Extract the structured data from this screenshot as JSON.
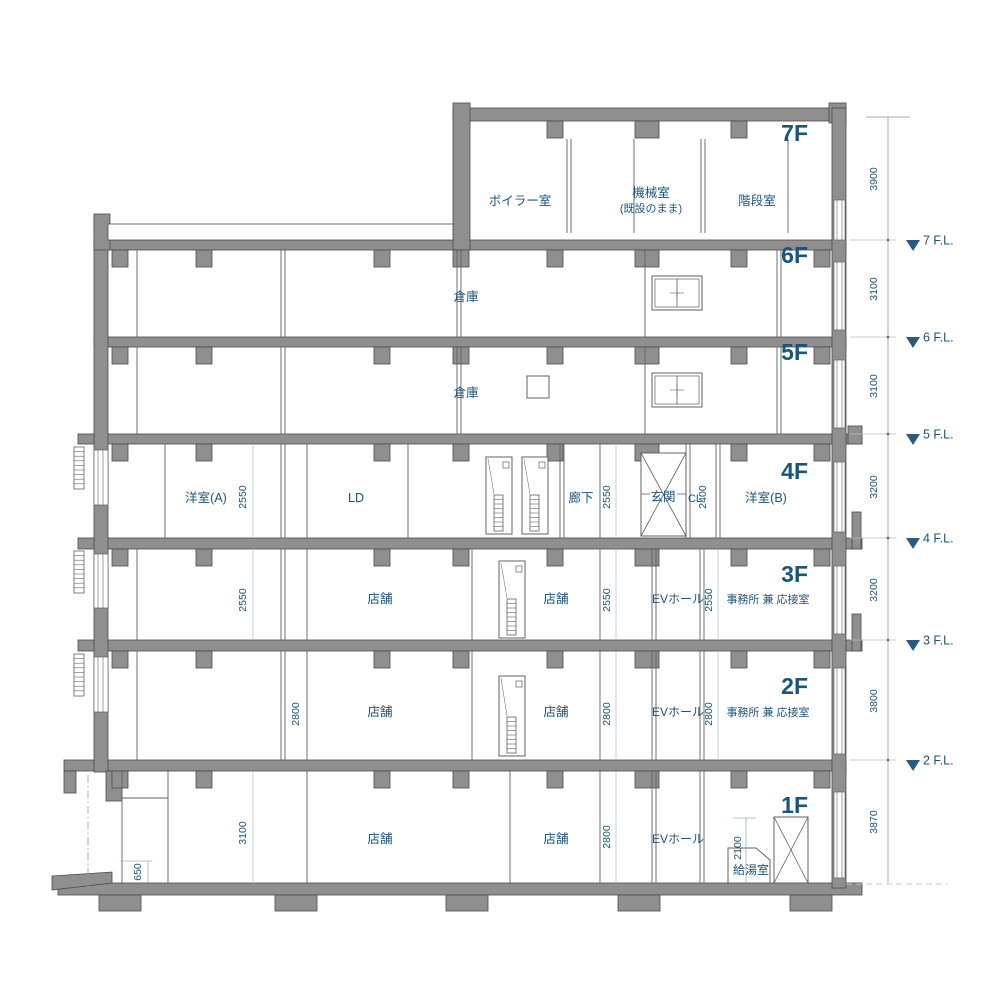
{
  "drawing": {
    "title": "building-cross-section",
    "colors": {
      "concrete_fill": "#8f8f8f",
      "concrete_stroke": "#4a4a4a",
      "thin_line": "#606060",
      "dim_line": "#9db7ca",
      "annotation_blue": "#1d5377",
      "fl_triangle": "#2a5a80"
    },
    "floor_labels": [
      {
        "text": "7F",
        "x": 808,
        "y": 141
      },
      {
        "text": "6F",
        "x": 808,
        "y": 263
      },
      {
        "text": "5F",
        "x": 808,
        "y": 360
      },
      {
        "text": "4F",
        "x": 808,
        "y": 479
      },
      {
        "text": "3F",
        "x": 808,
        "y": 582
      },
      {
        "text": "2F",
        "x": 808,
        "y": 694
      },
      {
        "text": "1F",
        "x": 808,
        "y": 813
      }
    ],
    "room_labels": [
      {
        "text": "ボイラー室",
        "x": 520,
        "y": 205,
        "size": 12.5
      },
      {
        "text": "機械室",
        "x": 651,
        "y": 197,
        "size": 12.5
      },
      {
        "text": "(既設のまま)",
        "x": 651,
        "y": 212,
        "size": 11
      },
      {
        "text": "階段室",
        "x": 757,
        "y": 205,
        "size": 12.5
      },
      {
        "text": "倉庫",
        "x": 466,
        "y": 301,
        "size": 12.5
      },
      {
        "text": "倉庫",
        "x": 466,
        "y": 397,
        "size": 12.5
      },
      {
        "text": "洋室(A)",
        "x": 206,
        "y": 502,
        "size": 12.5
      },
      {
        "text": "LD",
        "x": 356,
        "y": 502,
        "size": 12.5
      },
      {
        "text": "廊下",
        "x": 581,
        "y": 502,
        "size": 12.5
      },
      {
        "text": "玄関",
        "x": 663,
        "y": 501,
        "size": 12.5
      },
      {
        "text": "CL",
        "x": 695,
        "y": 502,
        "size": 11
      },
      {
        "text": "洋室(B)",
        "x": 766,
        "y": 502,
        "size": 12.5
      },
      {
        "text": "店舗",
        "x": 380,
        "y": 603,
        "size": 12.5
      },
      {
        "text": "店舗",
        "x": 556,
        "y": 603,
        "size": 12.5
      },
      {
        "text": "EVホール",
        "x": 678,
        "y": 603,
        "size": 12
      },
      {
        "text": "事務所 兼 応接室",
        "x": 768,
        "y": 603,
        "size": 11
      },
      {
        "text": "店舗",
        "x": 380,
        "y": 716,
        "size": 12.5
      },
      {
        "text": "店舗",
        "x": 556,
        "y": 716,
        "size": 12.5
      },
      {
        "text": "EVホール",
        "x": 678,
        "y": 716,
        "size": 12
      },
      {
        "text": "事務所 兼 応接室",
        "x": 768,
        "y": 716,
        "size": 11
      },
      {
        "text": "店舗",
        "x": 380,
        "y": 843,
        "size": 12.5
      },
      {
        "text": "店舗",
        "x": 556,
        "y": 843,
        "size": 12.5
      },
      {
        "text": "EVホール",
        "x": 678,
        "y": 843,
        "size": 12
      },
      {
        "text": "給湯室",
        "x": 751,
        "y": 874,
        "size": 12
      }
    ],
    "interior_dims": [
      {
        "text": "2550",
        "x": 246,
        "y": 497
      },
      {
        "text": "2550",
        "x": 610,
        "y": 497
      },
      {
        "text": "2400",
        "x": 706,
        "y": 497
      },
      {
        "text": "2550",
        "x": 246,
        "y": 600
      },
      {
        "text": "2550",
        "x": 610,
        "y": 600
      },
      {
        "text": "2550",
        "x": 712,
        "y": 600
      },
      {
        "text": "2800",
        "x": 299,
        "y": 714
      },
      {
        "text": "2800",
        "x": 610,
        "y": 714
      },
      {
        "text": "2800",
        "x": 712,
        "y": 714
      },
      {
        "text": "3100",
        "x": 246,
        "y": 833
      },
      {
        "text": "650",
        "x": 141,
        "y": 872
      },
      {
        "text": "2800",
        "x": 610,
        "y": 837
      },
      {
        "text": "2100",
        "x": 741,
        "y": 848
      }
    ],
    "right_dims": [
      {
        "text": "3900",
        "x": 877,
        "y": 179
      },
      {
        "text": "3100",
        "x": 877,
        "y": 289
      },
      {
        "text": "3100",
        "x": 877,
        "y": 386
      },
      {
        "text": "3200",
        "x": 877,
        "y": 487
      },
      {
        "text": "3200",
        "x": 877,
        "y": 590
      },
      {
        "text": "3800",
        "x": 877,
        "y": 701
      },
      {
        "text": "3870",
        "x": 877,
        "y": 822
      }
    ],
    "floor_level_markers": [
      {
        "text": "7 F.L.",
        "y": 240
      },
      {
        "text": "6 F.L.",
        "y": 337
      },
      {
        "text": "5 F.L.",
        "y": 434
      },
      {
        "text": "4 F.L.",
        "y": 538
      },
      {
        "text": "3 F.L.",
        "y": 640
      },
      {
        "text": "2 F.L.",
        "y": 760
      }
    ]
  }
}
